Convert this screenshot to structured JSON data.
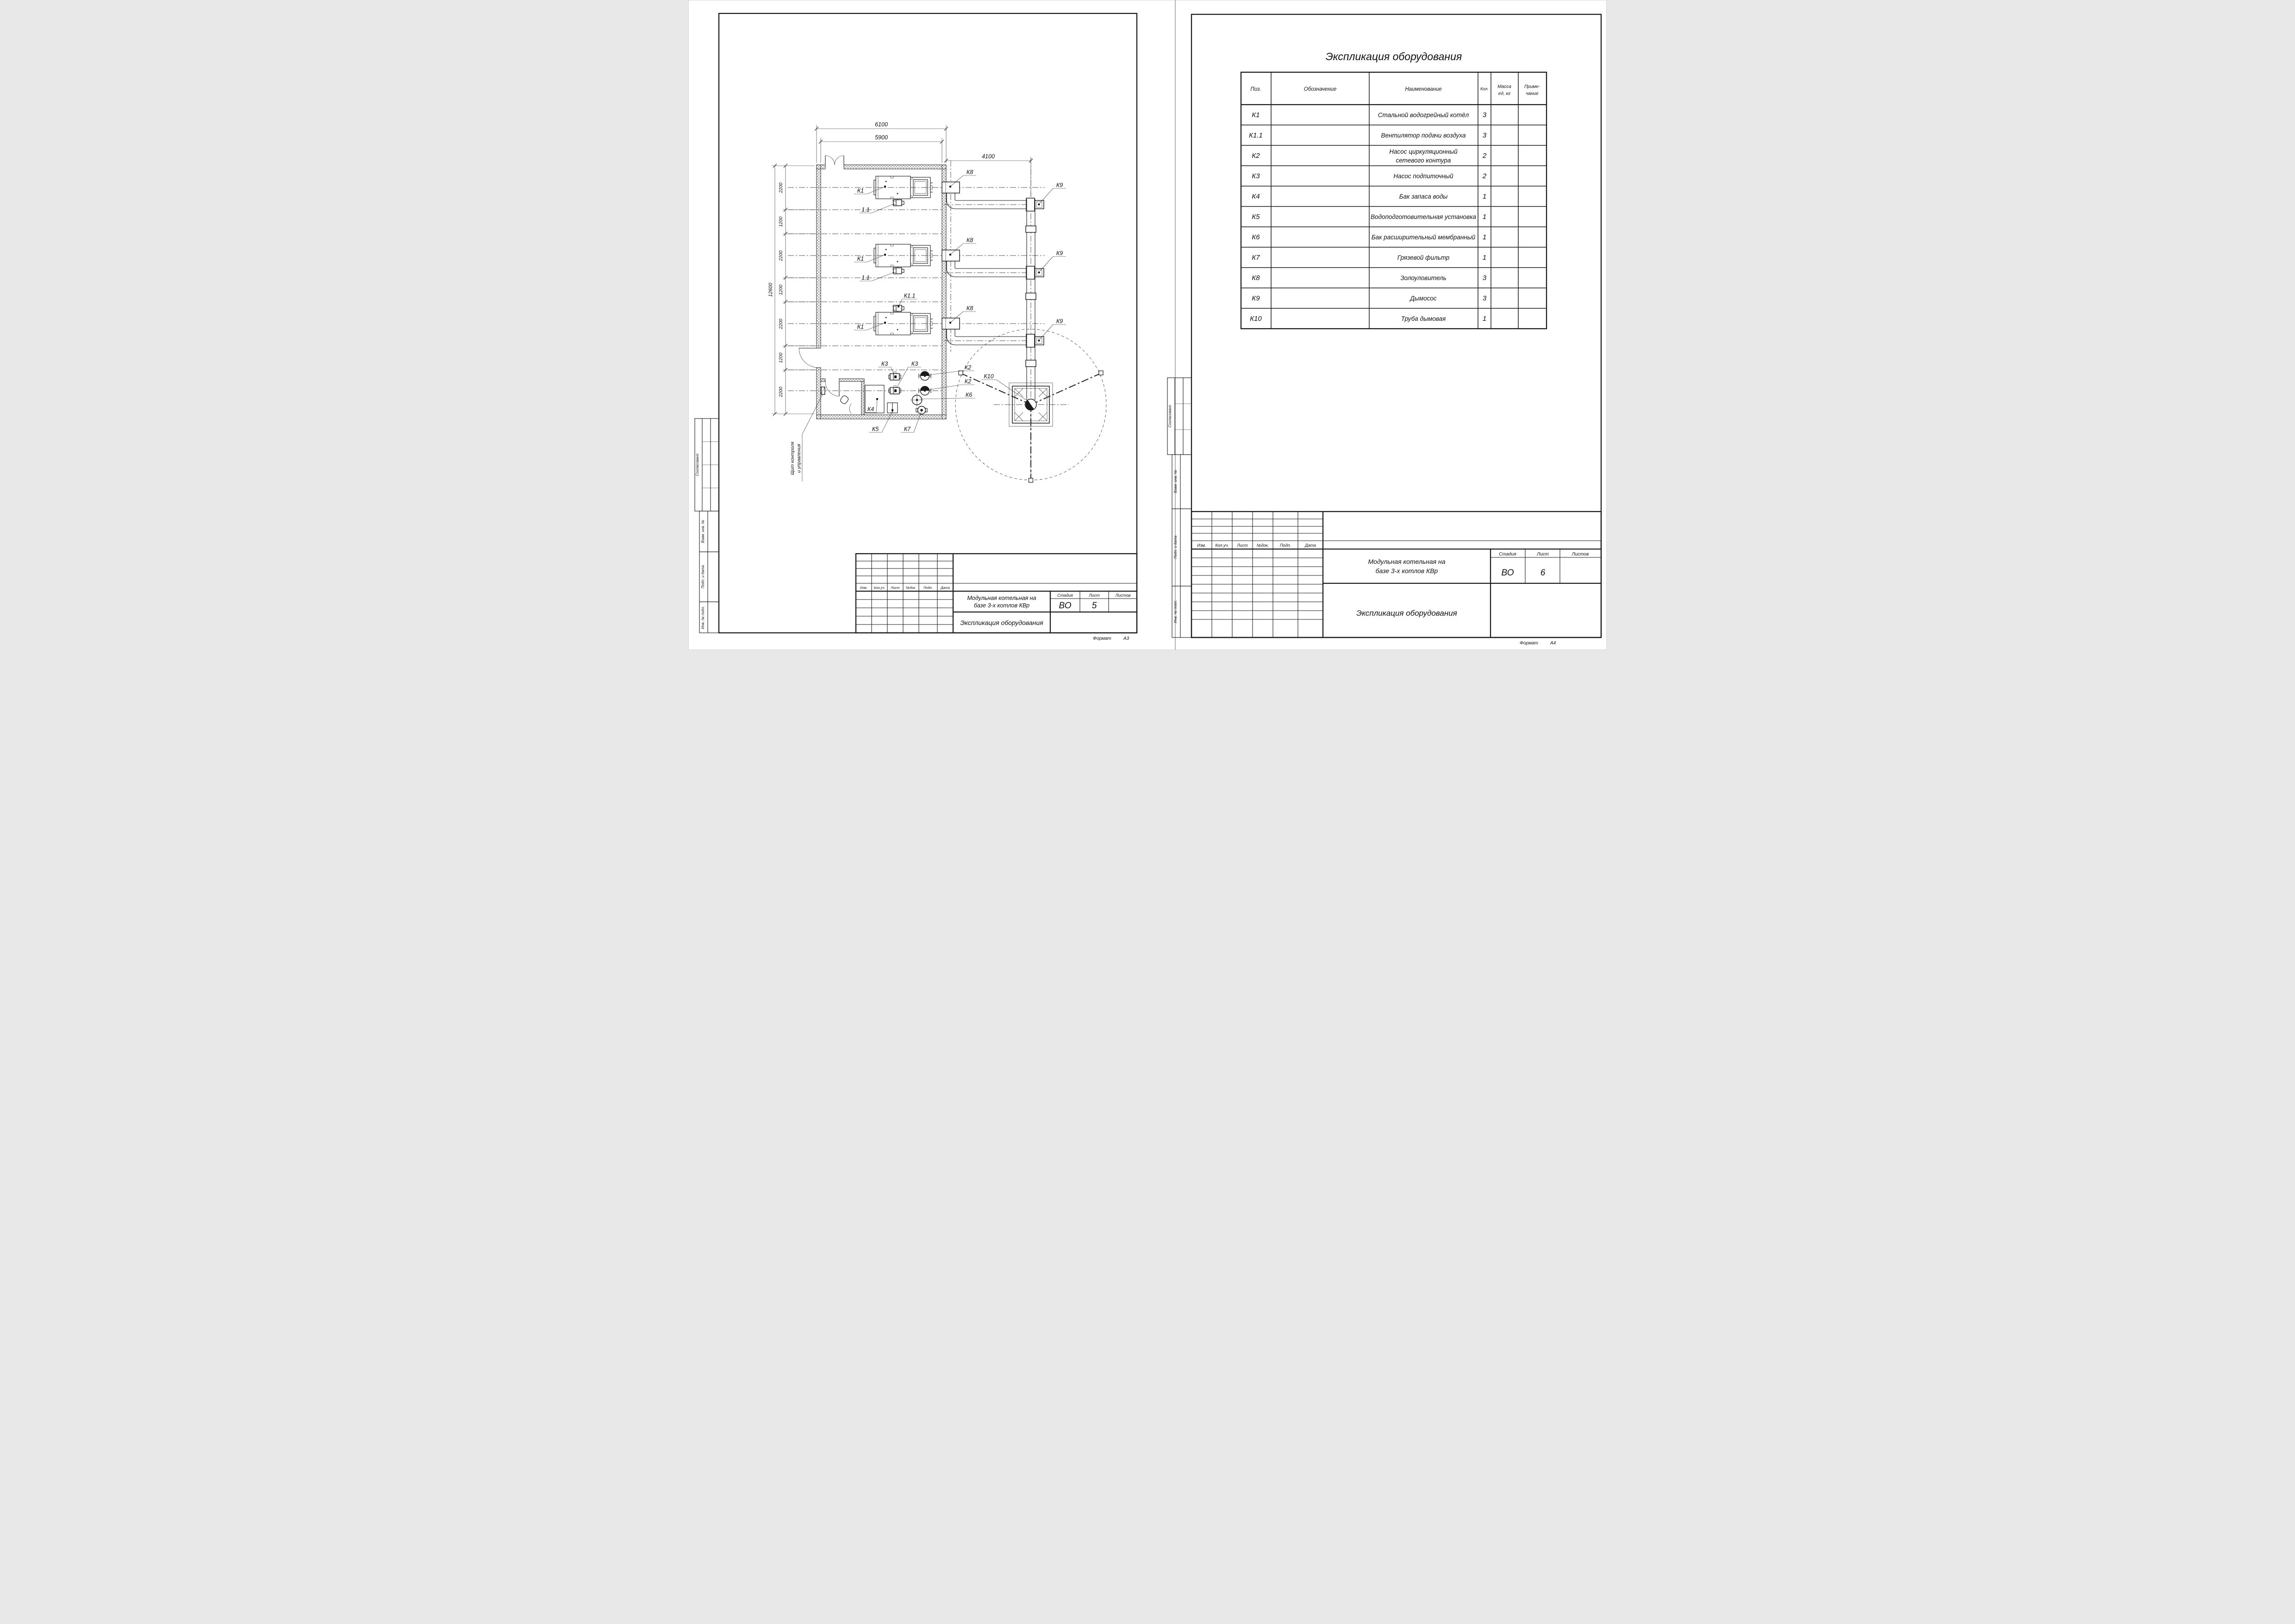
{
  "common": {
    "side_stamp": [
      "Согласовано",
      "Взам. инв. №",
      "Подп. и дата",
      "Инв. № подл."
    ],
    "rev_headers": [
      "Изм.",
      "Кол.уч.",
      "Лист",
      "№док.",
      "Подп.",
      "Дата"
    ],
    "project_line1": "Модульная котельная на",
    "project_line2": "базе 3-х котлов КВр",
    "doc_title": "Экспликация оборудования",
    "stage_label": "Стадия",
    "sheet_label": "Лист",
    "sheets_label": "Листов",
    "stage": "ВО",
    "format_label": "Формат"
  },
  "sheets": {
    "left": {
      "sheet_no": "5",
      "format_value": "А3",
      "plan": {
        "dims": {
          "top_outer": "6100",
          "top_inner": "5900",
          "right": "4100",
          "left_total": "12600",
          "seg0": "2200",
          "seg1": "1200",
          "seg2": "2200",
          "seg3": "1200",
          "seg4": "2200",
          "seg5": "1200",
          "seg6": "2200"
        },
        "labels": {
          "k1": "К1",
          "fan": "1.1",
          "fan3": "К1.1",
          "k2": "К2",
          "k3": "К3",
          "k4": "К4",
          "k5": "К5",
          "k6": "К6",
          "k7": "К7",
          "k8": "К8",
          "k9": "К9",
          "k10": "К10"
        },
        "note_line1": "Щит контроля",
        "note_line2": "и управления"
      }
    },
    "right": {
      "sheet_no": "6",
      "format_value": "А4",
      "table": {
        "title": "Экспликация оборудования",
        "headers": {
          "pos": "Поз.",
          "designation": "Обозначение",
          "name": "Наименование",
          "qty": "Кол.",
          "mass1": "Масса",
          "mass2": "ед, кг",
          "note1": "Приме-",
          "note2": "чание"
        },
        "rows": [
          {
            "pos": "К1",
            "name": "Стальной водогрейный котёл",
            "qty": "3"
          },
          {
            "pos": "К1.1",
            "name": "Вентилятор подачи воздуха",
            "qty": "3"
          },
          {
            "pos": "К2",
            "name2a": "Насос циркуляционный",
            "name2b": "сетевого контура",
            "qty": "2"
          },
          {
            "pos": "К3",
            "name": "Насос подпиточный",
            "qty": "2"
          },
          {
            "pos": "К4",
            "name": "Бак запаса воды",
            "qty": "1"
          },
          {
            "pos": "К5",
            "name": "Водоподготовительная установка",
            "qty": "1"
          },
          {
            "pos": "К6",
            "name": "Бак расширительный мембранный",
            "qty": "1"
          },
          {
            "pos": "К7",
            "name": "Грязевой фильтр",
            "qty": "1"
          },
          {
            "pos": "К8",
            "name": "Золоуловитель",
            "qty": "3"
          },
          {
            "pos": "К9",
            "name": "Дымосос",
            "qty": "3"
          },
          {
            "pos": "К10",
            "name": "Труба дымовая",
            "qty": "1"
          }
        ]
      }
    }
  }
}
